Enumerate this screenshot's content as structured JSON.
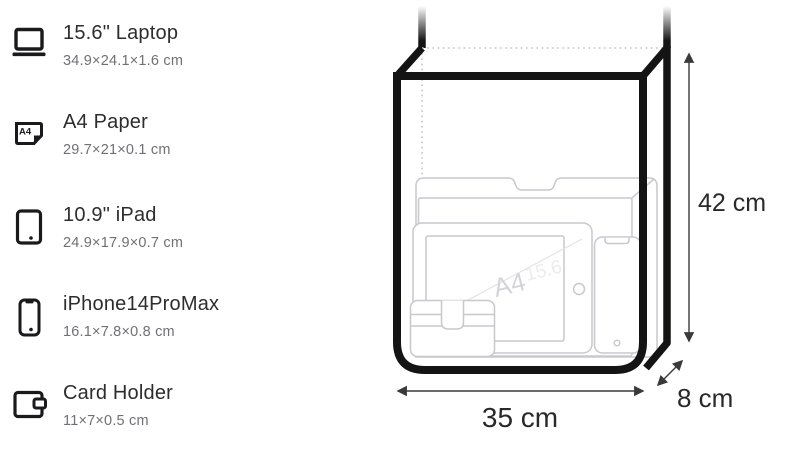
{
  "items": [
    {
      "icon": "laptop-icon",
      "name": "15.6\" Laptop",
      "dimensions": "34.9×24.1×1.6 cm"
    },
    {
      "icon": "a4-paper-icon",
      "name": "A4 Paper",
      "dimensions": "29.7×21×0.1 cm",
      "icon_label": "A4"
    },
    {
      "icon": "tablet-icon",
      "name": "10.9\" iPad",
      "dimensions": "24.9×17.9×0.7 cm"
    },
    {
      "icon": "phone-icon",
      "name": "iPhone14ProMax",
      "dimensions": "16.1×7.8×0.8 cm"
    },
    {
      "icon": "wallet-icon",
      "name": "Card Holder",
      "dimensions": "11×7×0.5 cm"
    }
  ],
  "diagram": {
    "height_label": "42 cm",
    "width_label": "35 cm",
    "depth_label": "8 cm",
    "watermark_primary": "A4",
    "watermark_secondary": "15.6"
  },
  "colors": {
    "bag_line": "#141414",
    "item_outline": "#c8c8cd",
    "hidden_edge_dotted": "#c4c4c6",
    "dimension_line": "#3a3a3c",
    "text_primary": "#2d2d2f",
    "text_secondary": "#707075",
    "watermark": "#d4d4d8"
  }
}
